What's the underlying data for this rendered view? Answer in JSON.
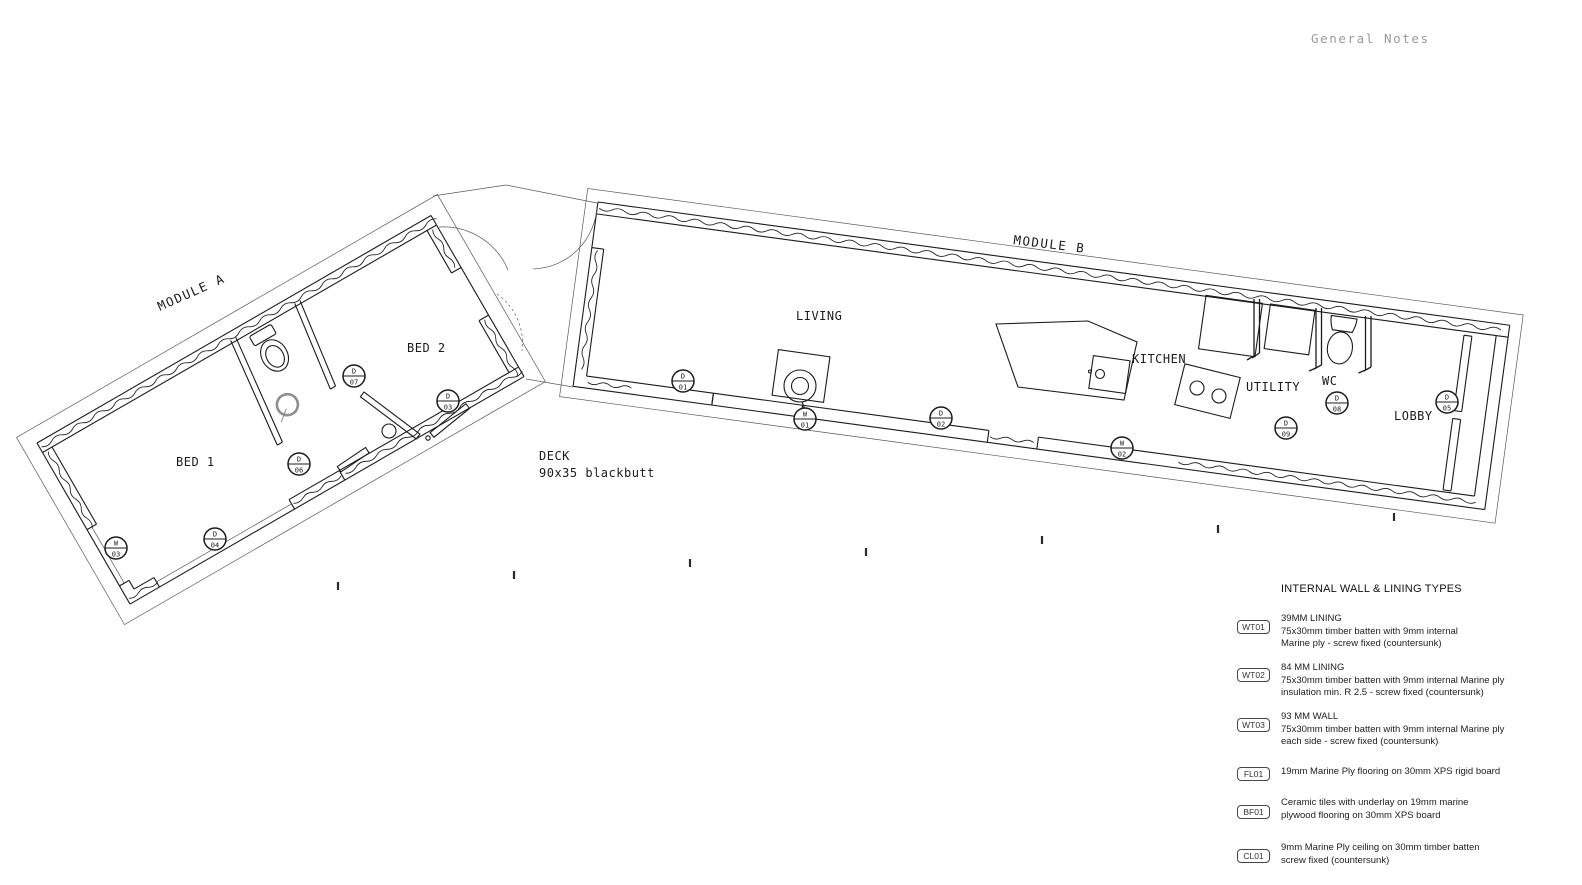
{
  "header": {
    "general_notes": "General Notes"
  },
  "plan": {
    "module_a_label": "MODULE A",
    "module_b_label": "MODULE B",
    "rooms": {
      "bed1": "BED 1",
      "bed2": "BED 2",
      "living": "LIVING",
      "kitchen": "KITCHEN",
      "utility": "UTILITY",
      "wc": "WC",
      "lobby": "LOBBY"
    },
    "deck": {
      "line1": "DECK",
      "line2": "90x35 blackbutt"
    },
    "markers": [
      {
        "top": "W",
        "bottom": "03"
      },
      {
        "top": "D",
        "bottom": "04"
      },
      {
        "top": "D",
        "bottom": "06"
      },
      {
        "top": "D",
        "bottom": "07"
      },
      {
        "top": "D",
        "bottom": "03"
      },
      {
        "top": "D",
        "bottom": "01"
      },
      {
        "top": "W",
        "bottom": "01"
      },
      {
        "top": "D",
        "bottom": "02"
      },
      {
        "top": "W",
        "bottom": "02"
      },
      {
        "top": "D",
        "bottom": "09"
      },
      {
        "top": "D",
        "bottom": "08"
      },
      {
        "top": "D",
        "bottom": "05"
      }
    ]
  },
  "legend": {
    "title": "INTERNAL WALL & LINING TYPES",
    "items": [
      {
        "code": "WT01",
        "lines": [
          "39MM LINING",
          "75x30mm timber batten with 9mm internal",
          "Marine ply - screw fixed (countersunk)"
        ]
      },
      {
        "code": "WT02",
        "lines": [
          "84 MM LINING",
          "75x30mm timber batten with 9mm internal Marine ply",
          "insulation min. R 2.5 - screw fixed (countersunk)"
        ]
      },
      {
        "code": "WT03",
        "lines": [
          "93  MM WALL",
          "75x30mm timber batten with 9mm internal Marine ply",
          "each side  - screw fixed (countersunk)"
        ]
      },
      {
        "code": "FL01",
        "lines": [
          "19mm Marine Ply flooring on 30mm XPS rigid board"
        ]
      },
      {
        "code": "BF01",
        "lines": [
          "Ceramic tiles with underlay on 19mm marine",
          "plywood flooring on 30mm XPS board"
        ]
      },
      {
        "code": "CL01",
        "lines": [
          "9mm Marine Ply ceiling on 30mm timber batten",
          "screw fixed (countersunk)"
        ]
      }
    ]
  },
  "colors": {
    "line": "#1b1b1b",
    "muted": "#9b9b9b"
  }
}
